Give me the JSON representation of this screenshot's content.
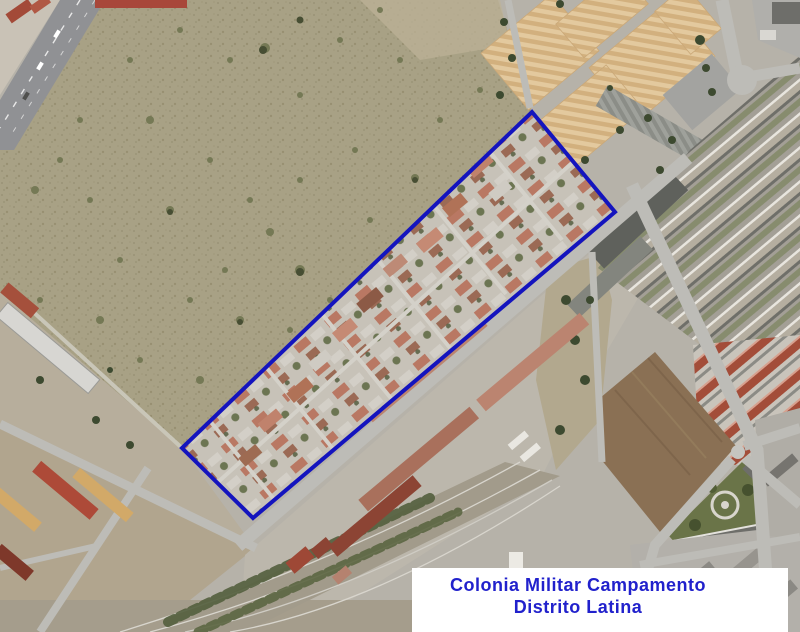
{
  "map": {
    "kind": "aerial-orthophoto",
    "label_box": {
      "line1": "Colonia Militar Campamento",
      "line2": "Distrito Latina",
      "text_color": "#2121cc",
      "background": "#ffffff"
    },
    "boundary": {
      "points": "532,112 615,212 253,518 182,448",
      "color": "#1414be",
      "stroke_width": 4
    },
    "palette": {
      "scrub_field": "#a8a185",
      "urban_ground": "#b6b2a9",
      "road": "#bdbcb7",
      "roof_terracotta": "#bb8470",
      "roof_dark_red": "#8c4434",
      "industrial_roof": "#e2c89c",
      "vegetation": "#55603c",
      "railway_gravel": "#a29b8b"
    },
    "features": [
      "scrubland-field",
      "colony-housing",
      "barracks",
      "industrial-warehouses",
      "apartment-blocks",
      "highway",
      "railway",
      "park-triangle"
    ]
  }
}
